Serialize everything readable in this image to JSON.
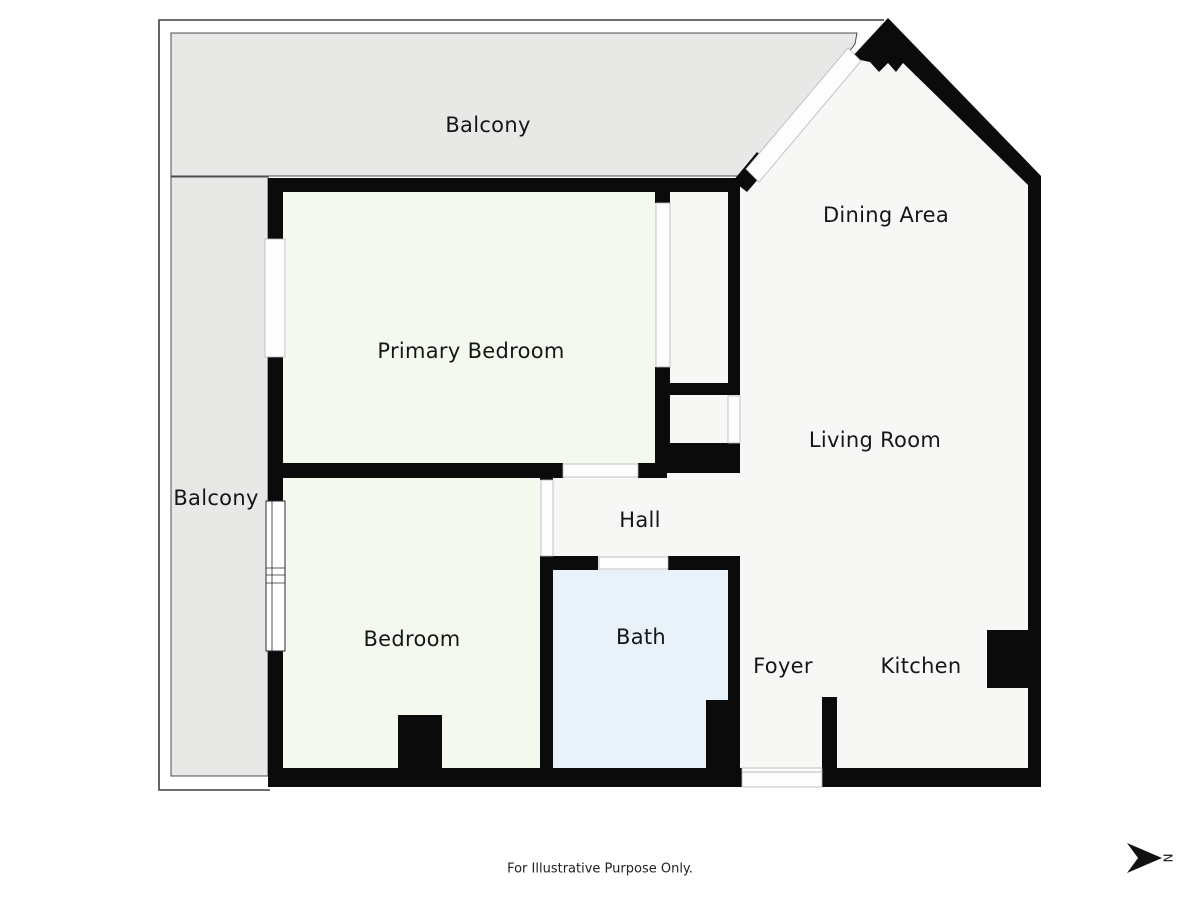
{
  "labels": {
    "balcony_top": "Balcony",
    "dining_area": "Dining Area",
    "primary_bedroom": "Primary Bedroom",
    "living_room": "Living Room",
    "balcony_left": "Balcony",
    "hall": "Hall",
    "bedroom": "Bedroom",
    "bath": "Bath",
    "foyer": "Foyer",
    "kitchen": "Kitchen"
  },
  "footer": {
    "disclaimer": "For Illustrative Purpose Only."
  },
  "compass": {
    "north_label": "N"
  },
  "colors": {
    "wall": "#0b0b0b",
    "balcony_fill": "#e8e8e7",
    "interior_fill": "#f7f7f5",
    "bedroom_fill": "#f3f9ee",
    "bath_fill": "#e9f2f8",
    "outline": "#3f3f3f",
    "opening_fill": "#fdfdfd",
    "opening_border": "#b5b5b5"
  }
}
